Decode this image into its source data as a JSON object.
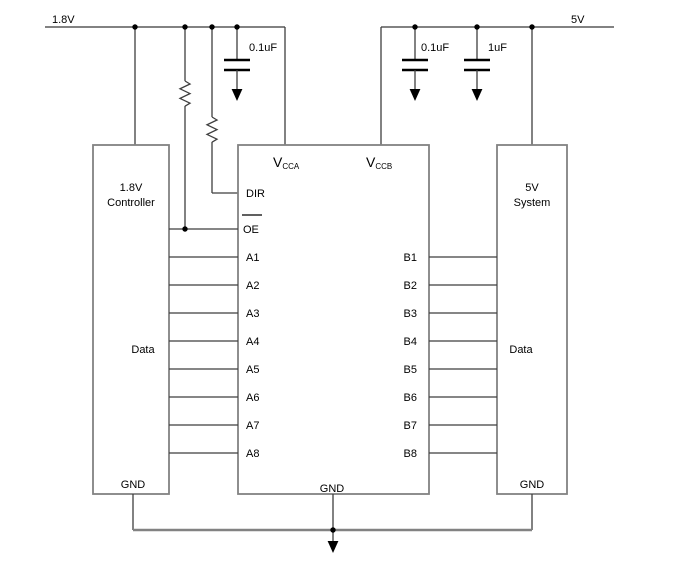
{
  "colors": {
    "background": "#ffffff",
    "ink": "#000000",
    "wire": "#3f3f3f",
    "rail": "#828282"
  },
  "power": {
    "left_rail": "1.8V",
    "right_rail": "5V"
  },
  "decoupling": {
    "cap1": "0.1uF",
    "cap2": "0.1uF",
    "cap3": "1uF"
  },
  "controller": {
    "line1": "1.8V",
    "line2": "Controller",
    "bus": "Data",
    "gnd": "GND"
  },
  "system": {
    "line1": "5V",
    "line2": "System",
    "bus": "Data",
    "gnd": "GND"
  },
  "ic": {
    "v": "V",
    "vcca_sub": "CCA",
    "vccb_sub": "CCB",
    "dir": "DIR",
    "oe": "OE",
    "gnd": "GND",
    "a_pins": [
      "A1",
      "A2",
      "A3",
      "A4",
      "A5",
      "A6",
      "A7",
      "A8"
    ],
    "b_pins": [
      "B1",
      "B2",
      "B3",
      "B4",
      "B5",
      "B6",
      "B7",
      "B8"
    ]
  }
}
